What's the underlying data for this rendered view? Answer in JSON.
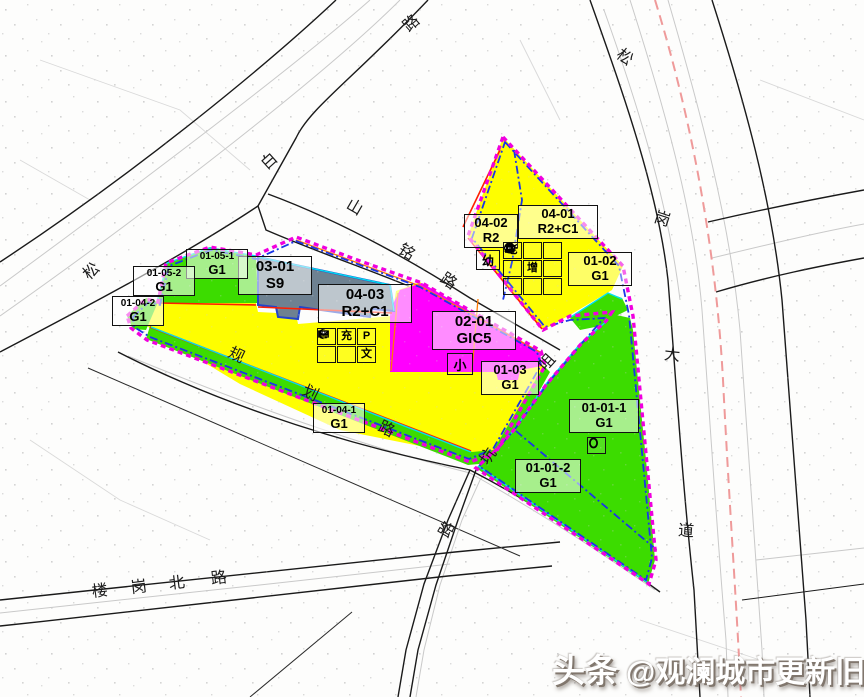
{
  "title": "观澜城市更新规划图",
  "colors": {
    "residential_yellow": "#FEFE00",
    "school_magenta": "#FF00FE",
    "green_space": "#3CDC00",
    "transport_slate": "#6E8191",
    "boundary_magenta": "#F000DE",
    "boundary_blue": "#1A35E8",
    "boundary_cyan": "#00E0F0",
    "parcel_red_line": "#FF1E00",
    "inner_orange_line": "#FF7A00",
    "metro_pink": "#EF9A9A",
    "road_line": "#1a1a1a"
  },
  "roads": [
    {
      "name": "松白路",
      "chars": [
        "松",
        "白",
        "路"
      ]
    },
    {
      "name": "山铭路",
      "chars": [
        "山",
        "铭",
        "路"
      ]
    },
    {
      "name": "规划路",
      "chars": [
        "规",
        "划",
        "路"
      ]
    },
    {
      "name": "咀坑路",
      "chars": [
        "咀",
        "坑",
        "路"
      ]
    },
    {
      "name": "楼岗北路",
      "chars": [
        "楼",
        "岗",
        "北",
        "路"
      ]
    },
    {
      "name": "松岗大道",
      "chars": [
        "松",
        "岗",
        "大",
        "道"
      ]
    }
  ],
  "parcels": [
    {
      "code": "04-03",
      "use": "R2+C1"
    },
    {
      "code": "02-01",
      "use": "GIC5"
    },
    {
      "code": "04-02",
      "use": "R2"
    },
    {
      "code": "04-01",
      "use": "R2+C1"
    },
    {
      "code": "03-01",
      "use": "S9"
    },
    {
      "code": "01-02",
      "use": "G1"
    },
    {
      "code": "01-03",
      "use": "G1"
    },
    {
      "code": "01-01-1",
      "use": "G1"
    },
    {
      "code": "01-01-2",
      "use": "G1"
    },
    {
      "code": "01-04-1",
      "use": "G1"
    },
    {
      "code": "01-04-2",
      "use": "G1"
    },
    {
      "code": "01-05-1",
      "use": "G1"
    },
    {
      "code": "01-05-2",
      "use": "G1"
    }
  ],
  "badges": {
    "kindergarten": "幼",
    "primary_school": "小"
  },
  "facility_icons": {
    "p0403": [
      {
        "name": "bus-station-icon"
      },
      {
        "name": "ev-charging-icon",
        "text": "充"
      },
      {
        "name": "parking-icon",
        "text": "P"
      },
      {
        "name": "post-office-icon"
      },
      {
        "name": "market-icon"
      },
      {
        "name": "culture-room-icon",
        "text": "文"
      }
    ],
    "p0401": [
      {
        "name": "elderly-care-icon",
        "text": "老"
      },
      {
        "name": "canteen-icon"
      },
      {
        "name": "community-home-icon"
      },
      {
        "name": "health-center-icon"
      },
      {
        "name": "capacity-increase-icon",
        "text": "增"
      },
      {
        "name": "community-service-icon"
      },
      {
        "name": "recycling-icon"
      },
      {
        "name": "public-toilet-icon"
      },
      {
        "name": "pavilion-icon"
      }
    ],
    "p0101": [
      {
        "name": "public-toilet-round-icon"
      }
    ]
  },
  "watermark": {
    "platform": "头条",
    "account": "@观澜城市更新旧改项目"
  }
}
